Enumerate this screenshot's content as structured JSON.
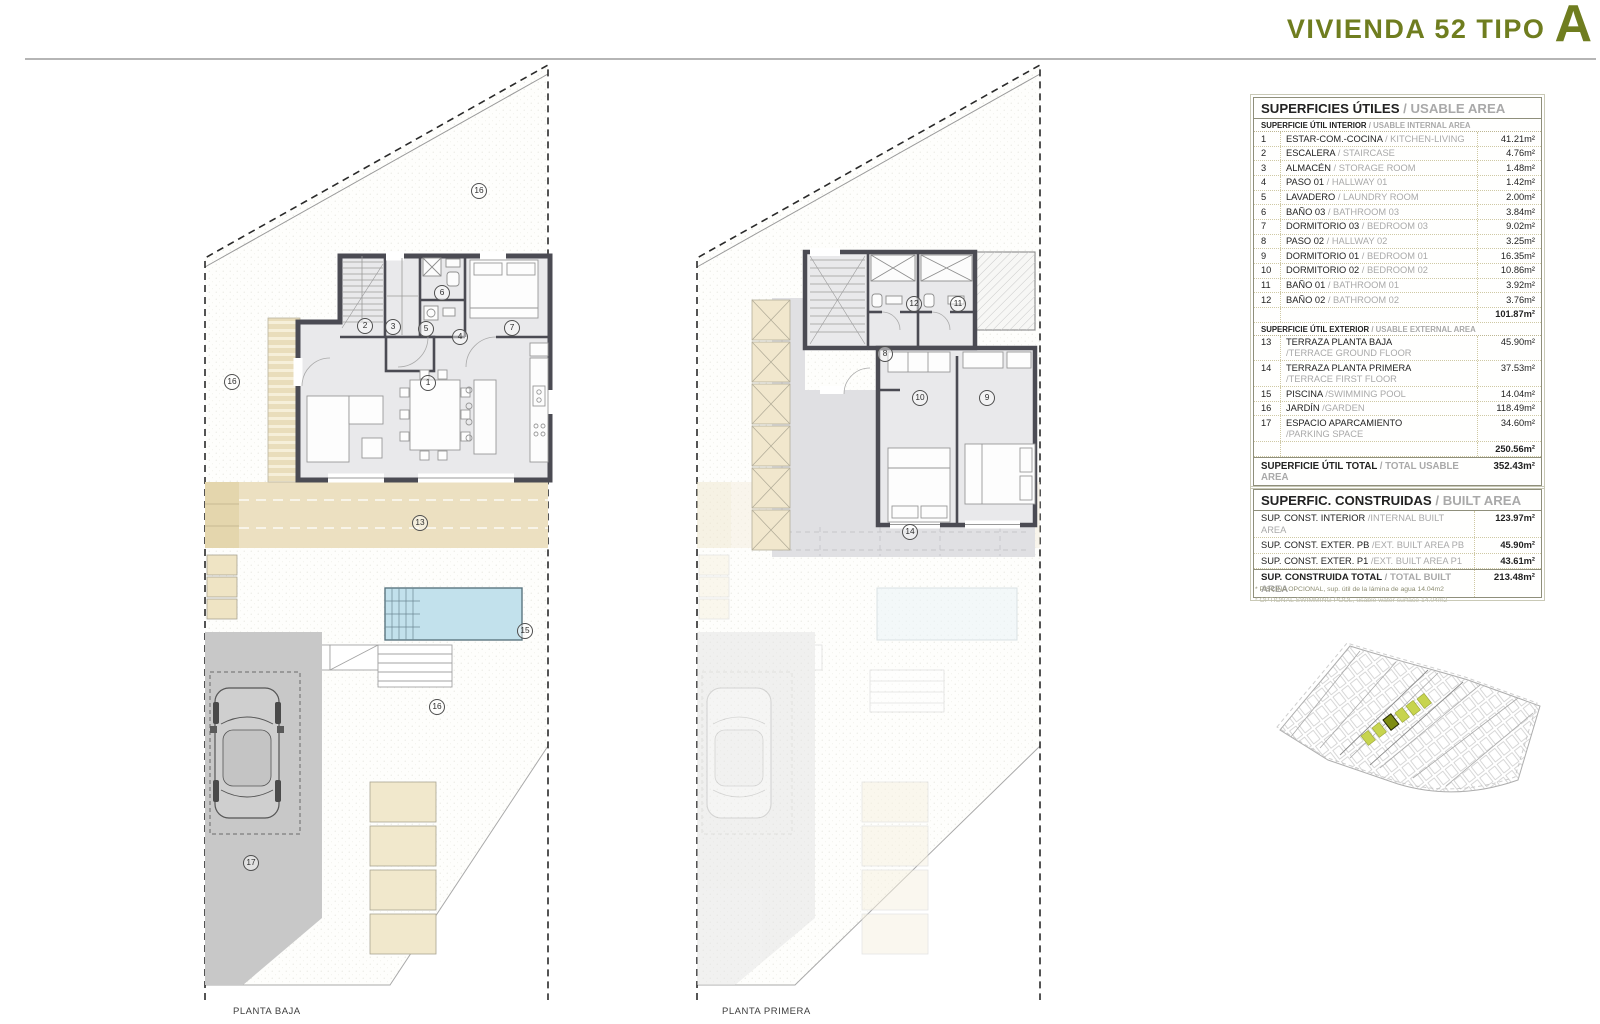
{
  "title": {
    "text": "VIVIENDA 52 TIPO",
    "type_letter": "A"
  },
  "plans": {
    "baja": {
      "caption": "PLANTA BAJA",
      "room_labels": [
        "16",
        "2",
        "3",
        "6",
        "5",
        "4",
        "7",
        "1",
        "16",
        "13",
        "15",
        "16",
        "17"
      ]
    },
    "primera": {
      "caption": "PLANTA PRIMERA",
      "room_labels": [
        "12",
        "11",
        "8",
        "10",
        "9",
        "14"
      ]
    }
  },
  "usable_table": {
    "title_es": "SUPERFICIES ÚTILES",
    "title_en": "/ USABLE AREA",
    "interior_header_es": "SUPERFICIE ÚTIL INTERIOR",
    "interior_header_en": "/ USABLE INTERNAL AREA",
    "interior_rows": [
      {
        "num": "1",
        "es": "ESTAR-COM.-COCINA",
        "en": "/ KITCHEN-LIVING",
        "value": "41.21m²"
      },
      {
        "num": "2",
        "es": "ESCALERA",
        "en": "/ STAIRCASE",
        "value": "4.76m²"
      },
      {
        "num": "3",
        "es": "ALMACÉN",
        "en": "/ STORAGE ROOM",
        "value": "1.48m²"
      },
      {
        "num": "4",
        "es": "PASO 01",
        "en": "/ HALLWAY 01",
        "value": "1.42m²"
      },
      {
        "num": "5",
        "es": "LAVADERO",
        "en": "/ LAUNDRY ROOM",
        "value": "2.00m²"
      },
      {
        "num": "6",
        "es": "BAÑO 03",
        "en": "/ BATHROOM 03",
        "value": "3.84m²"
      },
      {
        "num": "7",
        "es": "DORMITORIO 03",
        "en": "/ BEDROOM 03",
        "value": "9.02m²"
      },
      {
        "num": "8",
        "es": "PASO 02",
        "en": "/ HALLWAY 02",
        "value": "3.25m²"
      },
      {
        "num": "9",
        "es": "DORMITORIO 01",
        "en": "/ BEDROOM 01",
        "value": "16.35m²"
      },
      {
        "num": "10",
        "es": "DORMITORIO 02",
        "en": "/ BEDROOM 02",
        "value": "10.86m²"
      },
      {
        "num": "11",
        "es": "BAÑO 01",
        "en": "/ BATHROOM 01",
        "value": "3.92m²"
      },
      {
        "num": "12",
        "es": "BAÑO 02",
        "en": "/ BATHROOM 02",
        "value": "3.76m²"
      }
    ],
    "interior_total": "101.87m²",
    "exterior_header_es": "SUPERFICIE ÚTIL EXTERIOR",
    "exterior_header_en": "/ USABLE EXTERNAL AREA",
    "exterior_rows": [
      {
        "num": "13",
        "es": "TERRAZA PLANTA BAJA",
        "en": "/TERRACE GROUND FLOOR",
        "value": "45.90m²"
      },
      {
        "num": "14",
        "es": "TERRAZA PLANTA PRIMERA",
        "en": "/TERRACE FIRST FLOOR",
        "value": "37.53m²"
      },
      {
        "num": "15",
        "es": "PISCINA",
        "en": "/SWIMMING POOL",
        "value": "14.04m²"
      },
      {
        "num": "16",
        "es": "JARDÍN",
        "en": "/GARDEN",
        "value": "118.49m²"
      },
      {
        "num": "17",
        "es": "ESPACIO APARCAMIENTO",
        "en": "/PARKING SPACE",
        "value": "34.60m²"
      }
    ],
    "exterior_total": "250.56m²",
    "total_label_es": "SUPERFICIE ÚTIL TOTAL",
    "total_label_en": "/ TOTAL USABLE AREA",
    "total_value": "352.43m²"
  },
  "built_table": {
    "title_es": "SUPERFIC. CONSTRUIDAS",
    "title_en": "/ BUILT AREA",
    "rows": [
      {
        "es": "SUP. CONST. INTERIOR",
        "en": "/INTERNAL BUILT AREA",
        "value": "123.97m²"
      },
      {
        "es": "SUP. CONST. EXTER. PB",
        "en": "/EXT. BUILT AREA PB",
        "value": "45.90m²"
      },
      {
        "es": "SUP. CONST. EXTER. P1",
        "en": "/EXT. BUILT AREA P1",
        "value": "43.61m²"
      }
    ],
    "total_es": "SUP. CONSTRUIDA TOTAL",
    "total_en": "/ TOTAL BUILT AREA",
    "total_value": "213.48m²",
    "footnote_1": "* PISCINA OPCIONAL, sup. útil de la lámina de agua 14.04m2",
    "footnote_2": "* OPTIONAL SWIMMING POOL, usable water surface 14.04m2"
  },
  "colors": {
    "accent_olive": "#6f7d1f",
    "wall_gray": "#4b4b53",
    "pool": "#c2e1ec",
    "terrace": "#ece0c1",
    "parking": "#c8c8c8",
    "floor": "#e9e9eb",
    "upper_terrace": "#e0e0e3",
    "site_highlight": "#c7d44e",
    "site_selected": "#7e8c12"
  }
}
